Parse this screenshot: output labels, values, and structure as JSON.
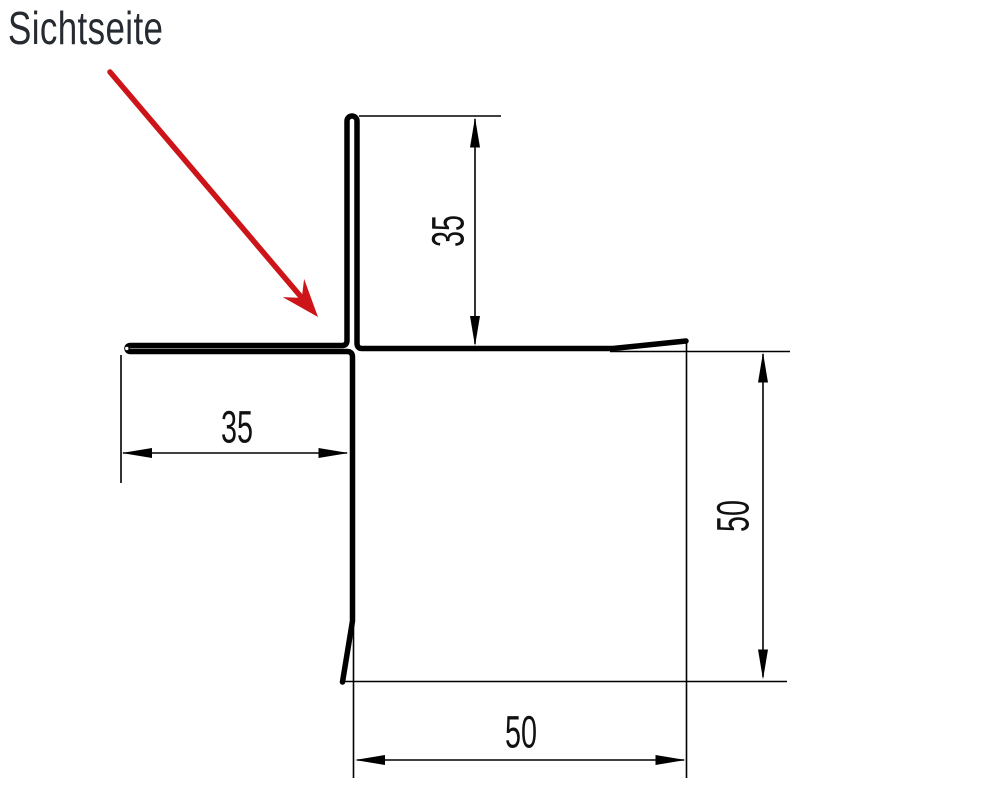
{
  "annotation": {
    "visible_side_label": "Sichtseite"
  },
  "dimensions": {
    "upstand": "35",
    "left_leg": "35",
    "right_height": "50",
    "bottom_width": "50"
  },
  "colors": {
    "line": "#000000",
    "accent_red": "#cd1418",
    "label_text": "#262b31"
  }
}
